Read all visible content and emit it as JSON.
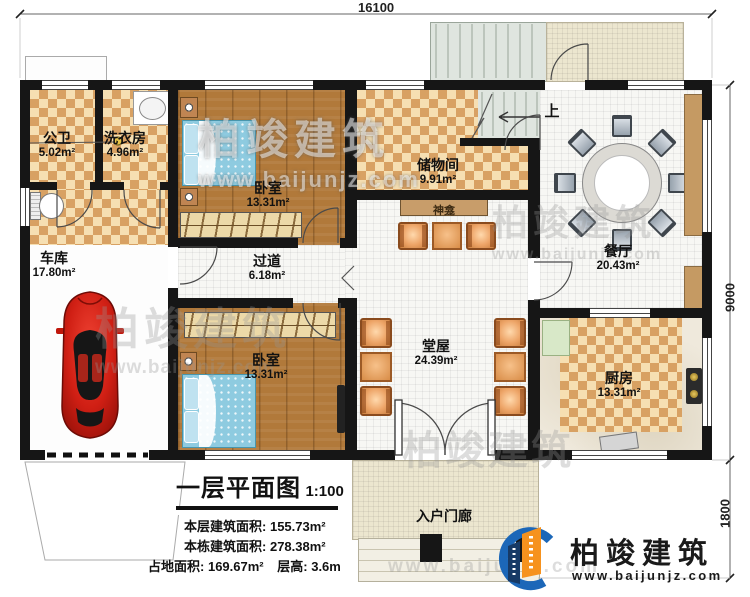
{
  "brand": {
    "name": "柏竣建筑",
    "website": "www.baijunjz.com"
  },
  "dimensions": {
    "top": "16100",
    "right_upper": "9000",
    "right_lower": "1800"
  },
  "stairs": {
    "direction_label": "上"
  },
  "rooms": [
    {
      "id": "bath",
      "name": "公卫",
      "area": "5.02m²"
    },
    {
      "id": "laundry",
      "name": "洗衣房",
      "area": "4.96m²"
    },
    {
      "id": "bedroom1",
      "name": "卧室",
      "area": "13.31m²"
    },
    {
      "id": "storage",
      "name": "储物间",
      "area": "9.91m²"
    },
    {
      "id": "shrine",
      "name": "神龛",
      "area": ""
    },
    {
      "id": "dining",
      "name": "餐厅",
      "area": "20.43m²"
    },
    {
      "id": "garage",
      "name": "车库",
      "area": "17.80m²"
    },
    {
      "id": "hallway",
      "name": "过道",
      "area": "6.18m²"
    },
    {
      "id": "bedroom2",
      "name": "卧室",
      "area": "13.31m²"
    },
    {
      "id": "hall",
      "name": "堂屋",
      "area": "24.39m²"
    },
    {
      "id": "kitchen",
      "name": "厨房",
      "area": "13.31m²"
    },
    {
      "id": "porch",
      "name": "入户门廊",
      "area": ""
    }
  ],
  "legend": {
    "title": "一层平面图",
    "scale": "1:100",
    "row1_label": "本层建筑面积:",
    "row1_value": "155.73m²",
    "row2_label": "本栋建筑面积:",
    "row2_value": "278.38m²",
    "row3_label": "占地面积:",
    "row3_value": "169.67m²",
    "row3b_label": "层高:",
    "row3b_value": "3.6m"
  },
  "colors": {
    "wall": "#161616",
    "checker_dark": "#d8a163",
    "wood": "#b1793a",
    "logo_blue": "#1c67b8",
    "logo_orange": "#f6921e",
    "car_red": "#d01f14"
  }
}
